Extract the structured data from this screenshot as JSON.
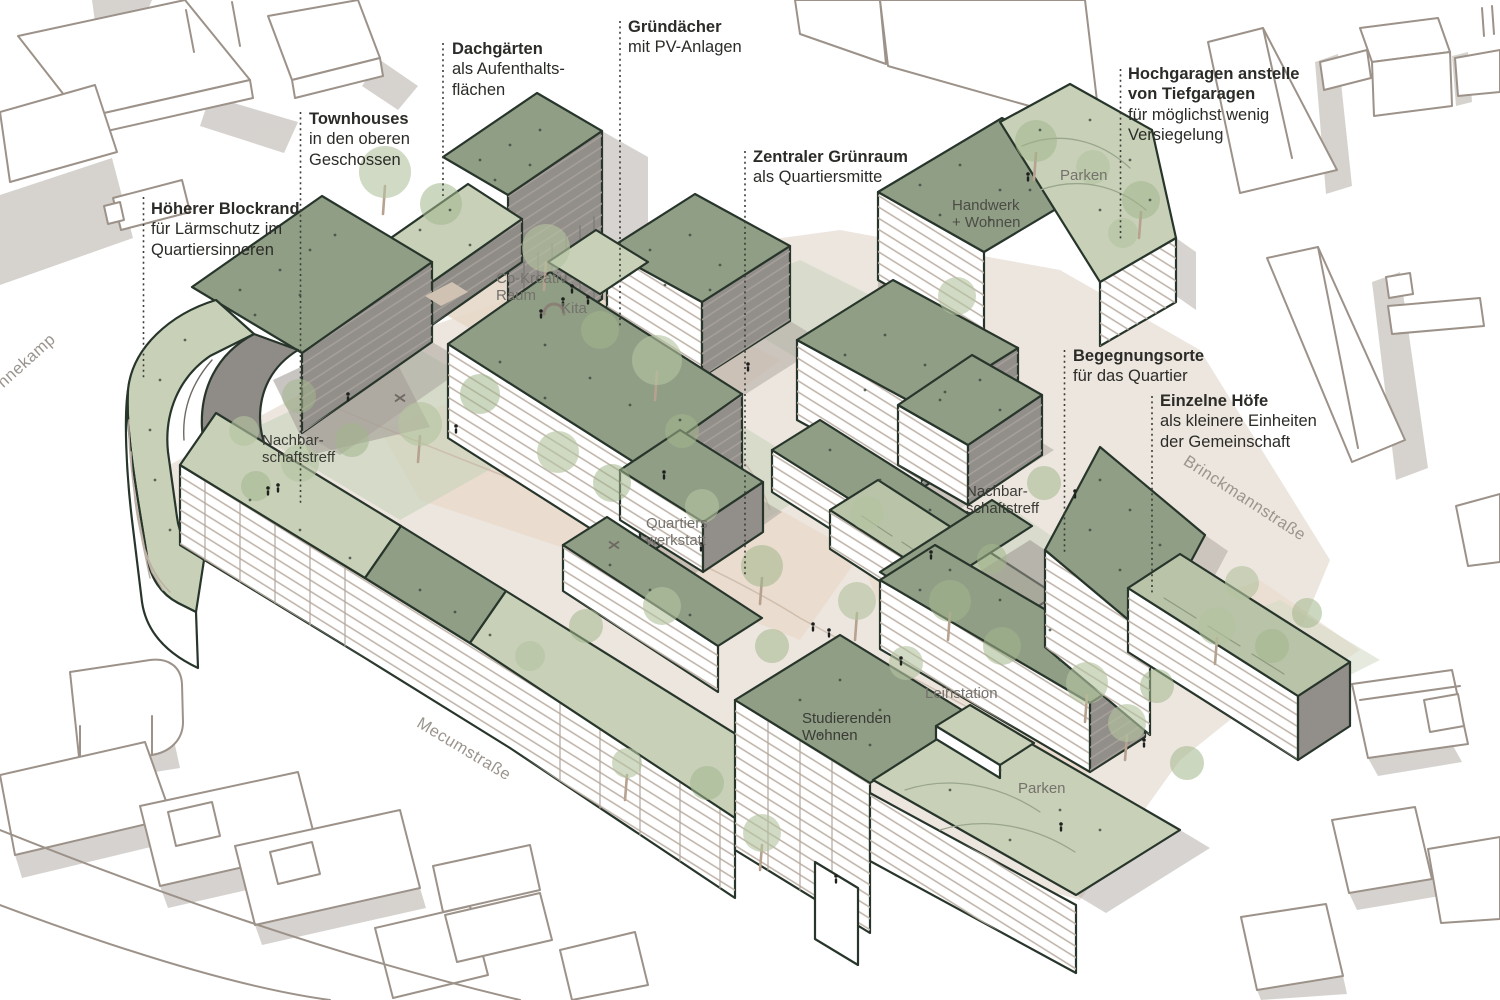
{
  "figure": {
    "style": "Hand-drawn axonometric urban masterplan sketch",
    "background": "#ffffff"
  },
  "annotations": {
    "hoeherer": {
      "lines": [
        "Höherer Blockrand",
        "für Lärmschutz im",
        "Quartiersinneren"
      ]
    },
    "townhouses": {
      "lines": [
        "Townhouses",
        "in den oberen",
        "Geschossen"
      ]
    },
    "dachgaerten": {
      "lines": [
        "Dachgärten",
        "als Aufenthalts-",
        "flächen"
      ]
    },
    "gruendaecher": {
      "lines": [
        "Gründächer",
        "mit PV-Anlagen"
      ]
    },
    "zentraler": {
      "lines": [
        "Zentraler Grünraum",
        "als Quartiersmitte"
      ]
    },
    "hochgaragen": {
      "lines": [
        "Hochgaragen anstelle",
        "von Tiefgaragen",
        "für möglichst wenig",
        "Versiegelung"
      ]
    },
    "begegnungsorte": {
      "lines": [
        "Begegnungsorte",
        "für das Quartier"
      ]
    },
    "einzelne": {
      "lines": [
        "Einzelne Höfe",
        "als kleinere Einheiten",
        "der Gemeinschaft"
      ]
    }
  },
  "site_labels": {
    "co_kreativ": {
      "lines": [
        "Co-Kreativ",
        "Raum"
      ]
    },
    "kita": {
      "lines": [
        "Kita"
      ]
    },
    "quartierswerkstatt": {
      "lines": [
        "Quartiers",
        "werkstatt"
      ]
    },
    "nachbar_links": {
      "lines": [
        "Nachbar-",
        "schaftstreff"
      ]
    },
    "nachbar_rechts": {
      "lines": [
        "Nachbar-",
        "schaftstreff"
      ]
    },
    "handwerk": {
      "lines": [
        "Handwerk",
        "+ Wohnen"
      ]
    },
    "parken_nord": {
      "lines": [
        "Parken"
      ]
    },
    "parken_sued": {
      "lines": [
        "Parken"
      ]
    },
    "leihstation": {
      "lines": [
        "Leihstation"
      ]
    },
    "studierenden": {
      "lines": [
        "Studierenden",
        "Wohnen"
      ]
    }
  },
  "streets": {
    "nnekamp": "nnekamp",
    "mecumstrasse": "Mecumstraße",
    "brinckmannstrasse": "Brinckmannstraße"
  },
  "colors": {
    "ink": "#27352b",
    "roof_sage": "#8f9e85",
    "roof_pale": "#c8d1b8",
    "facade_gray": "#928e89",
    "stripe_taupe": "#bcb0a5",
    "ground_beige": "#ece5dd",
    "ground_path": "#e9d9c9",
    "ground_green": "#ccd4bf",
    "tree_green": "#b2c29e",
    "context_line": "#9c9289",
    "shadow_gray": "#a8a19b",
    "label_dark": "#2b2b27",
    "label_gray": "#75716c",
    "street_gray": "#9b948e",
    "leader": "#3c3c38"
  }
}
